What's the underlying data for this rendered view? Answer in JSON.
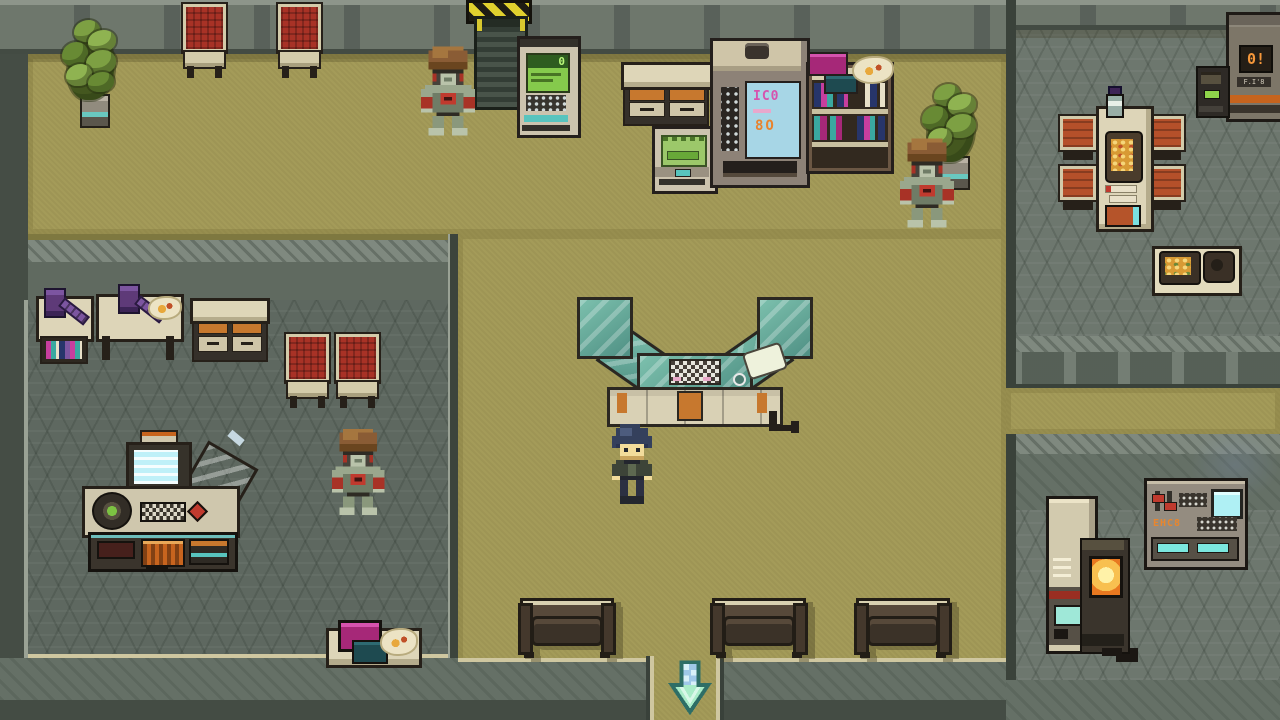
{
  "scene": {
    "title": "Sci-fi facility lobby",
    "description": "Top-down 16-bit pixel-art interior: reception counter, vending machines, robot NPCs, waiting area and side rooms",
    "player": {
      "label": "Player character",
      "facing": "down"
    },
    "npcs": [
      {
        "label": "Robot NPC - north hall"
      },
      {
        "label": "Robot NPC - east hall"
      },
      {
        "label": "Robot NPC - west room"
      }
    ],
    "exit": {
      "label": "South exit",
      "direction": "down"
    }
  },
  "screens": {
    "atm_display": "0",
    "vending_display_top": "IC0",
    "vending_display_bottom": "8O",
    "orange_machine_display": "0!",
    "orange_machine_label": "F.I'8",
    "control_panel_readout": "EHC8"
  },
  "labels": {
    "player": "Player character",
    "robot_north": "Robot NPC (north hall)",
    "robot_east": "Robot NPC (east hall)",
    "robot_west": "Robot NPC (west room)",
    "reception_desk": "Reception counter with terminal",
    "door_north": "Sliding door with hazard sign",
    "hazard_sign": "Hazard stripe sign",
    "atm": "ATM terminal",
    "vending_machine": "Vending machine",
    "bookshelf": "Bookshelf with books and maps",
    "drawer_counter": "Storage counter with orange drawers",
    "ticket_machine": "Ticket machine",
    "plant": "Potted plant",
    "chair_red": "Waiting chair (red cushion)",
    "bench": "Lobby bench",
    "exit_arrow": "Exit marker (south)",
    "dining_table": "Dining table with food",
    "dining_chair": "Dining chair (orange cushion)",
    "bottle": "Dispenser bottle",
    "food_tray": "Food tray table",
    "orange_machine": "Dispenser machine with orange display",
    "kiosk": "Small terminal kiosk",
    "control_panel": "Wall control panel",
    "locker": "Utility locker unit",
    "furnace": "Furnace with orange glow",
    "work_table_a": "Lab table with canister and books",
    "work_table_b": "Lab table with canister and supplies",
    "cabinet": "Drawer cabinet",
    "console": "Computer workstation console",
    "side_table": "Side table with tablets"
  },
  "palette": {
    "floor_tan": "#a49b59",
    "floor_stone": "#6d776e",
    "floor_stone_dark": "#5e6860",
    "wall": "#59615a",
    "wall_light": "#8d958a",
    "outline": "#262019",
    "furniture_cream": "#d6cdaa",
    "accent_orange": "#c7782e",
    "cushion_red": "#a83226",
    "glass_teal": "#569a8c",
    "screen_cyan": "#a7d6e6",
    "screen_green": "#85ca4c",
    "arrow_mint": "#a9ecc8",
    "hazard_yellow": "#e0d02e",
    "robot_green": "#9aa78d",
    "robot_brown": "#8a5c35",
    "player_hair": "#34405c"
  }
}
